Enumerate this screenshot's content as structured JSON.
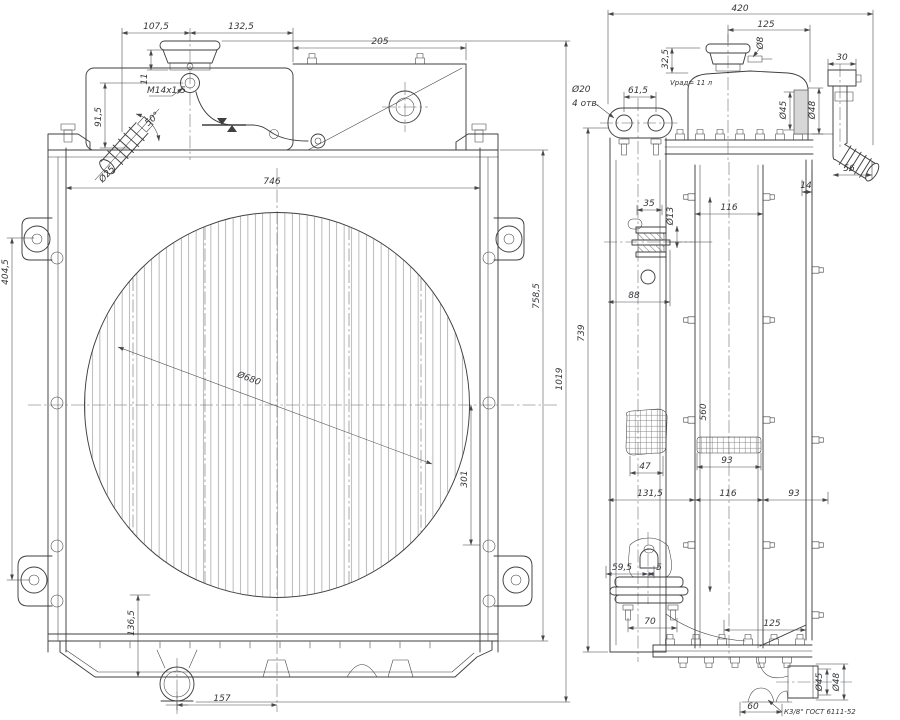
{
  "colors": {
    "line": "#3f3f3f",
    "dimension": "#44484c",
    "hatch": "#8d8d8d",
    "centerline": "#5f6468",
    "section_fill": "#d7d7d7",
    "background": "#ffffff"
  },
  "front": {
    "d107_5": "107,5",
    "d132_5": "132,5",
    "d205": "205",
    "d11": "11",
    "thread": "M14x1,5",
    "d91_5": "91,5",
    "a50": "50°",
    "dia25": "Ø25",
    "d746": "746",
    "d404_5": "404,5",
    "dia680": "Ø680",
    "d758_5": "758,5",
    "d301": "301",
    "d136_5": "136,5",
    "d157": "157",
    "d1019": "1019"
  },
  "side": {
    "d420": "420",
    "d125_top": "125",
    "dia8": "Ø8",
    "d32_5": "32,5",
    "d30": "30",
    "dia20": "Ø20",
    "holes4": "4 отв.",
    "d61_5": "61,5",
    "volume": "Vрад= 11 л",
    "dia45_top": "Ø45",
    "dia48_top": "Ø48",
    "d56": "56",
    "d14": "14",
    "d35": "35",
    "dia13": "Ø13",
    "d116_mid": "116",
    "d88": "88",
    "d560": "560",
    "d47": "47",
    "d93_mid": "93",
    "d131_5": "131,5",
    "d116_bot": "116",
    "d93_bot": "93",
    "d59_5": "59,5",
    "d5": "5",
    "d70": "70",
    "d125_bot": "125",
    "d60": "60",
    "dia45_bot": "Ø45",
    "dia48_bot": "Ø48",
    "fitting": "К3/8\" ГОСТ 6111-52",
    "d739": "739"
  }
}
